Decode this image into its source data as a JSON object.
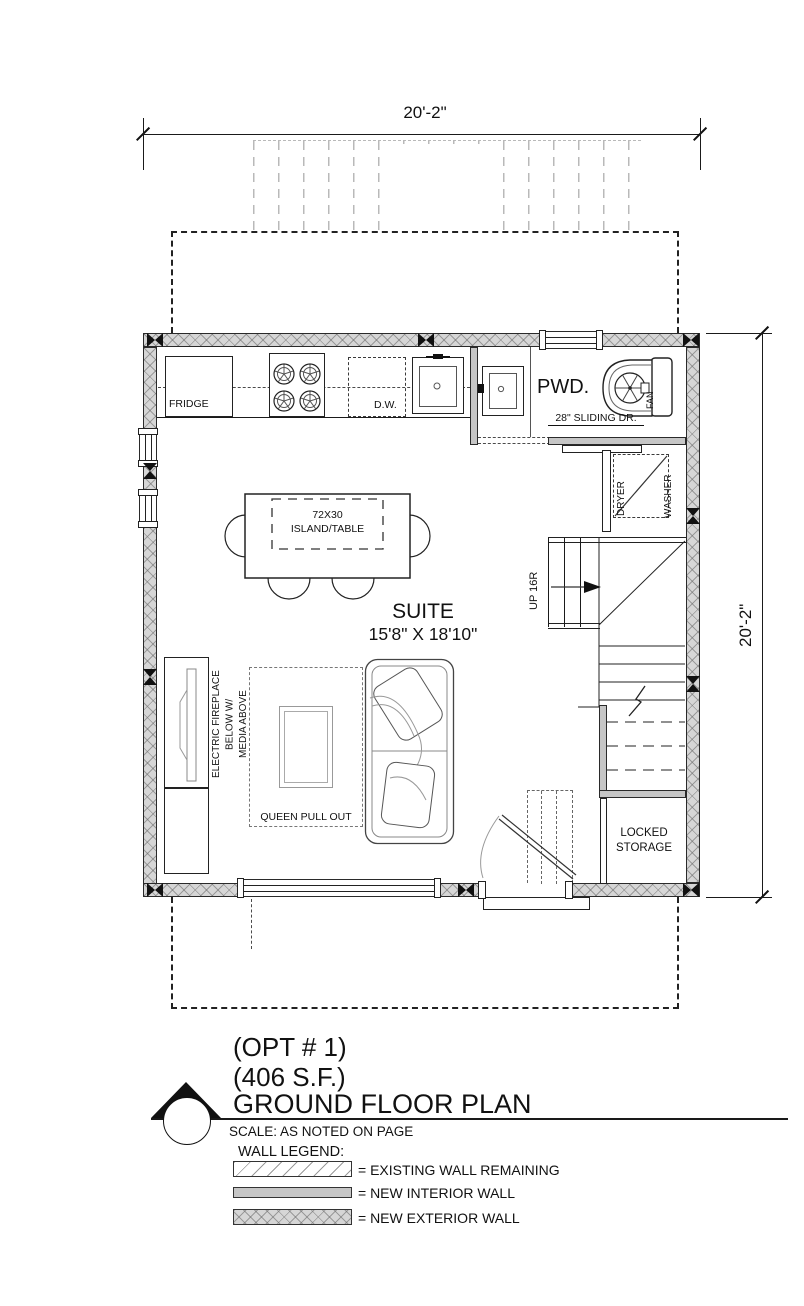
{
  "colors": {
    "exterior_wall_fill": "#d6d6d6",
    "interior_wall_fill": "#c6c6c6",
    "line": "#1a1a1a",
    "overhead_dash_gray": "#b9b9b9"
  },
  "dimensions": {
    "top": "20'-2\"",
    "right": "20'-2\""
  },
  "plan": {
    "kitchen": {
      "fridge": "FRIDGE",
      "dishwasher": "D.W."
    },
    "powder_room": {
      "label": "PWD.",
      "fan": "FAN",
      "door": "28\" SLIDING DR."
    },
    "laundry": {
      "dryer": "DRYER",
      "washer": "WASHER"
    },
    "stairs": {
      "direction": "UP 16R"
    },
    "island": {
      "size": "72X30",
      "name": "ISLAND/TABLE"
    },
    "suite": {
      "name": "SUITE",
      "dimensions": "15'8\" X 18'10\""
    },
    "fireplace": {
      "line1": "ELECTRIC FIREPLACE",
      "line2": "BELOW W/",
      "line3": "MEDIA ABOVE"
    },
    "sofa": "QUEEN PULL OUT",
    "storage": "LOCKED STORAGE"
  },
  "title_block": {
    "option": "(OPT # 1)",
    "area": "(406 S.F.)",
    "title": "GROUND FLOOR PLAN",
    "scale": "SCALE: AS NOTED ON PAGE",
    "legend_heading": "WALL LEGEND:",
    "legend": [
      {
        "label": "= EXISTING WALL REMAINING"
      },
      {
        "label": "= NEW INTERIOR WALL"
      },
      {
        "label": "= NEW EXTERIOR WALL"
      }
    ]
  }
}
